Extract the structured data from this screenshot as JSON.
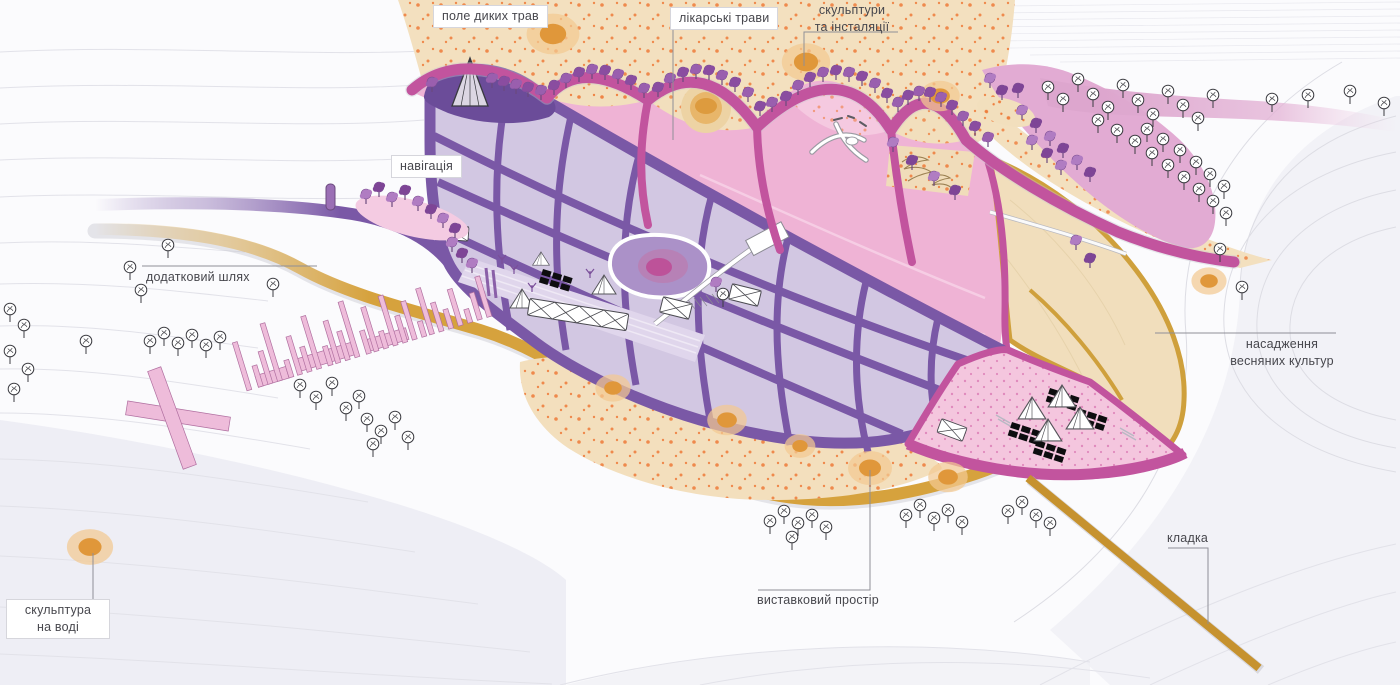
{
  "page": {
    "title": "Park landscape masterplan illustration",
    "language": "uk",
    "width": 1400,
    "height": 685
  },
  "annotations": {
    "wild_grass_field": {
      "label": "поле диких трав",
      "boxed": true
    },
    "medicinal_herbs": {
      "label": "лікарські трави",
      "boxed": true
    },
    "sculptures_installations": {
      "label": "скульптури\nта інсталяції",
      "boxed": false
    },
    "navigation": {
      "label": "навігація",
      "boxed": true
    },
    "additional_path": {
      "label": "додатковий шлях",
      "boxed": false
    },
    "spring_crops_planting": {
      "label": "насадження\nвесняних культур",
      "boxed": false
    },
    "exhibition_space": {
      "label": "виставковий простір",
      "boxed": false
    },
    "footbridge": {
      "label": "кладка",
      "boxed": false
    },
    "water_sculpture": {
      "label": "скульптура\nна воді",
      "boxed": true
    }
  },
  "zones": [
    {
      "name": "wild grass field",
      "fill": "#f3e0bf"
    },
    {
      "name": "medicinal herbs field",
      "fill": "#f3e0bf"
    },
    {
      "name": "crop grid plots",
      "fill": "#d2c7e2"
    },
    {
      "name": "pond plaza",
      "fill": "#ab91c8"
    },
    {
      "name": "spring crops leaf",
      "fill": "#f1debc"
    },
    {
      "name": "event zone",
      "fill": "#f4c6de"
    },
    {
      "name": "exhibition field",
      "fill": "#f3dfbd"
    },
    {
      "name": "gold loop path",
      "fill": "#d6a23d"
    },
    {
      "name": "purple entry path",
      "fill": "#7a58a6"
    },
    {
      "name": "magenta promenade",
      "fill": "#c2549e"
    },
    {
      "name": "pink grove band",
      "fill": "#dfa9d0"
    },
    {
      "name": "sculpture markers",
      "fill": "#e0973a"
    }
  ],
  "colors": {
    "background": "#fbfbfd",
    "contour": "#e2e2e9",
    "label_text": "#47474d",
    "leader_line": "#8f8f97",
    "orange_dot": "#ee7430",
    "pink_dot": "#cc4d9b"
  }
}
